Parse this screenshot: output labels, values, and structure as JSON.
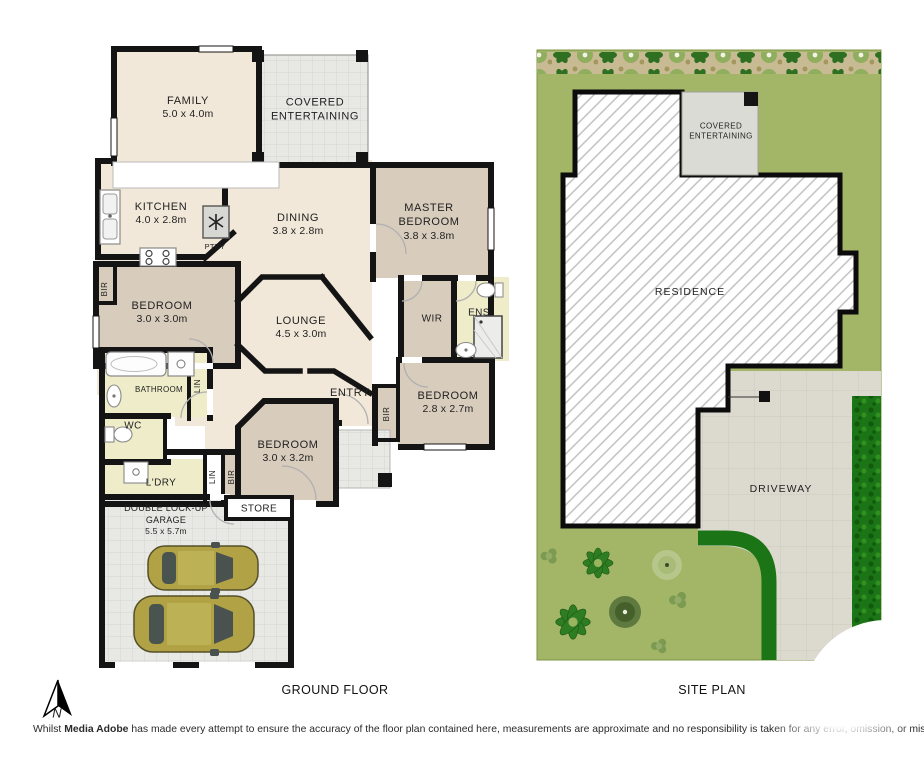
{
  "floor_plan": {
    "title": "GROUND FLOOR",
    "rooms": {
      "family": {
        "name": "FAMILY",
        "dims": "5.0 x 4.0m"
      },
      "covered_entertaining": {
        "name": "COVERED ENTERTAINING"
      },
      "kitchen": {
        "name": "KITCHEN",
        "dims": "4.0 x 2.8m"
      },
      "pantry": {
        "name": "PTRY"
      },
      "dining": {
        "name": "DINING",
        "dims": "3.8 x 2.8m"
      },
      "master_bedroom": {
        "name": "MASTER BEDROOM",
        "dims": "3.8 x 3.8m"
      },
      "bedroom_2": {
        "name": "BEDROOM",
        "dims": "3.0 x 3.0m"
      },
      "lounge": {
        "name": "LOUNGE",
        "dims": "4.5 x 3.0m"
      },
      "wir": {
        "name": "WIR"
      },
      "ensuite": {
        "name": "ENS"
      },
      "bathroom": {
        "name": "BATHROOM"
      },
      "wc": {
        "name": "WC"
      },
      "laundry": {
        "name": "L'DRY"
      },
      "bedroom_3": {
        "name": "BEDROOM",
        "dims": "3.0 x 3.2m"
      },
      "entry": {
        "name": "ENTRY"
      },
      "bedroom_4": {
        "name": "BEDROOM",
        "dims": "2.8 x 2.7m"
      },
      "store": {
        "name": "STORE"
      },
      "garage": {
        "name": "DOUBLE LOCK-UP GARAGE",
        "dims": "5.5 x 5.7m"
      }
    },
    "closets": {
      "bir_1": "BIR",
      "bir_2": "BIR",
      "bir_3": "BIR",
      "lin_1": "LIN",
      "lin_2": "LIN"
    }
  },
  "site_plan": {
    "title": "SITE PLAN",
    "labels": {
      "covered_entertaining": "COVERED ENTERTAINING",
      "residence": "RESIDENCE",
      "driveway": "DRIVEWAY"
    }
  },
  "compass": {
    "north": "N"
  },
  "disclaimer": {
    "prefix": "Whilst ",
    "brand": "Media Adobe",
    "rest": " has made every attempt to ensure the accuracy of the floor plan contained here, measurements are approximate and no responsibility is taken for any error, omission, or mis-statement. This plan is for illustrative purposes on"
  },
  "colors": {
    "wall": "#141414",
    "floor_living": "#f1e8d9",
    "floor_bedroom": "#d8ccbd",
    "floor_wet": "#eeecc9",
    "outdoor_grey": "#e8e8e4",
    "lawn": "#a3b566",
    "hedge": "#1b7416",
    "driveway": "#dcd9cf",
    "car_body": "#b0a245"
  },
  "icons": {
    "north_arrow": "north-arrow-icon",
    "car": "car-icon",
    "bath": "bath-icon",
    "shower": "shower-icon",
    "toilet": "toilet-icon",
    "sink": "sink-icon",
    "cooktop": "cooktop-icon",
    "fridge": "fridge-icon",
    "plant": "plant-icon"
  }
}
